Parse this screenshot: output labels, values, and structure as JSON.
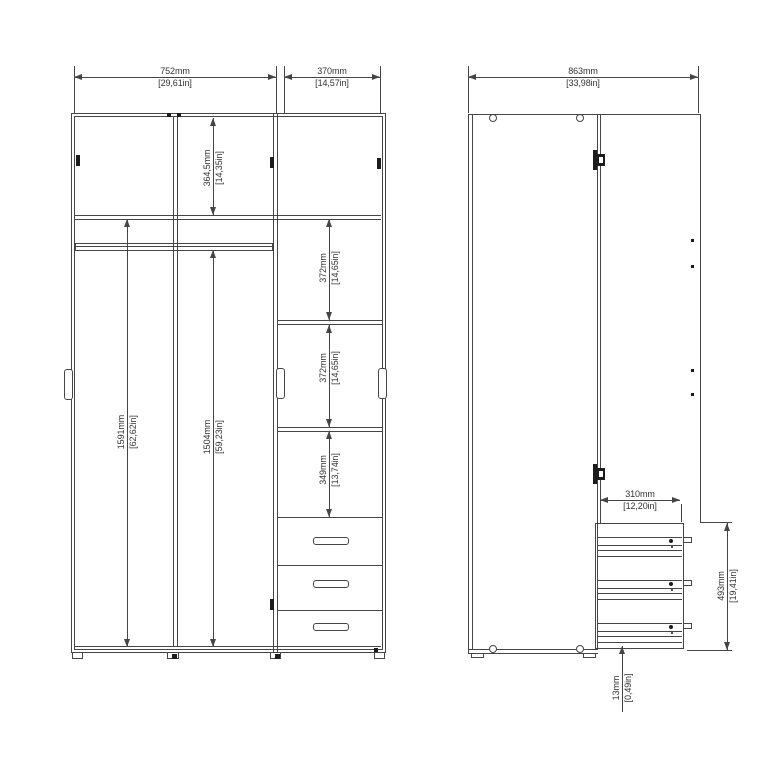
{
  "colors": {
    "background": "#ffffff",
    "line": "#454545",
    "text": "#333333",
    "hardware": "#1c1c1c"
  },
  "dimensions": {
    "front_width_left": {
      "mm": "752mm",
      "inches": "[29,61in]"
    },
    "front_width_right": {
      "mm": "370mm",
      "inches": "[14,57in]"
    },
    "front_top_section_height": {
      "mm": "364,5mm",
      "inches": "[14,35in]"
    },
    "front_left_interior_height": {
      "mm": "1591mm",
      "inches": "[62,62in]"
    },
    "front_below_rail_height": {
      "mm": "1504mm",
      "inches": "[59,23in]"
    },
    "front_shelf_gap_1": {
      "mm": "372mm",
      "inches": "[14,65in]"
    },
    "front_shelf_gap_2": {
      "mm": "372mm",
      "inches": "[14,65in]"
    },
    "front_shelf_gap_3": {
      "mm": "349mm",
      "inches": "[13,74in]"
    },
    "side_total_width": {
      "mm": "863mm",
      "inches": "[33,98in]"
    },
    "side_drawer_depth": {
      "mm": "310mm",
      "inches": "[12,20in]"
    },
    "side_drawer_stack_height": {
      "mm": "493mm",
      "inches": "[19,41in]"
    },
    "side_floor_clearance": {
      "mm": "13mm",
      "inches": "[0,49in]"
    }
  }
}
